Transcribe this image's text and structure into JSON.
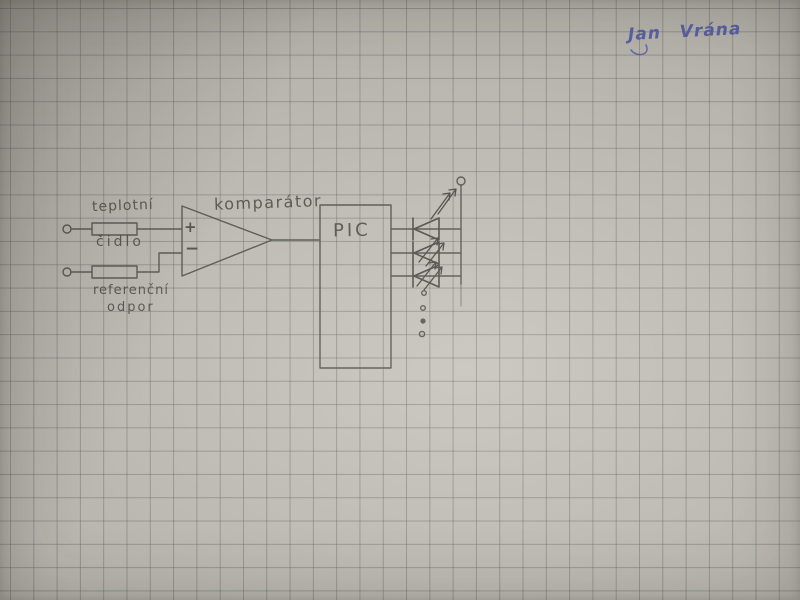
{
  "signature": {
    "text": "Jan Vrána",
    "ink_color": "#4c57a3"
  },
  "schematic": {
    "labels": {
      "sensor_line1": "teplotní",
      "sensor_line2": "čidlo",
      "reference_line1": "referenční",
      "reference_line2": "odpor",
      "comparator": "komparátor",
      "plus_input": "+",
      "minus_input": "−",
      "mcu": "PIC"
    },
    "components": [
      {
        "name": "input-terminal-top"
      },
      {
        "name": "temperature-sensor-resistor",
        "label": "teplotní čidlo"
      },
      {
        "name": "input-terminal-bottom"
      },
      {
        "name": "reference-resistor",
        "label": "referenční odpor"
      },
      {
        "name": "comparator",
        "label": "komparátor",
        "inputs": [
          "+",
          "−"
        ]
      },
      {
        "name": "microcontroller",
        "label": "PIC"
      },
      {
        "name": "led-outputs",
        "led_count": 3
      },
      {
        "name": "continuation-dots",
        "dot_count": 4
      },
      {
        "name": "output-terminal"
      }
    ],
    "colors": {
      "paper": "#b8b5ae",
      "grid_line": "#8f9092",
      "pencil": "#514f4a",
      "ink": "#4c57a3"
    },
    "grid_cell_px": 23.3
  }
}
